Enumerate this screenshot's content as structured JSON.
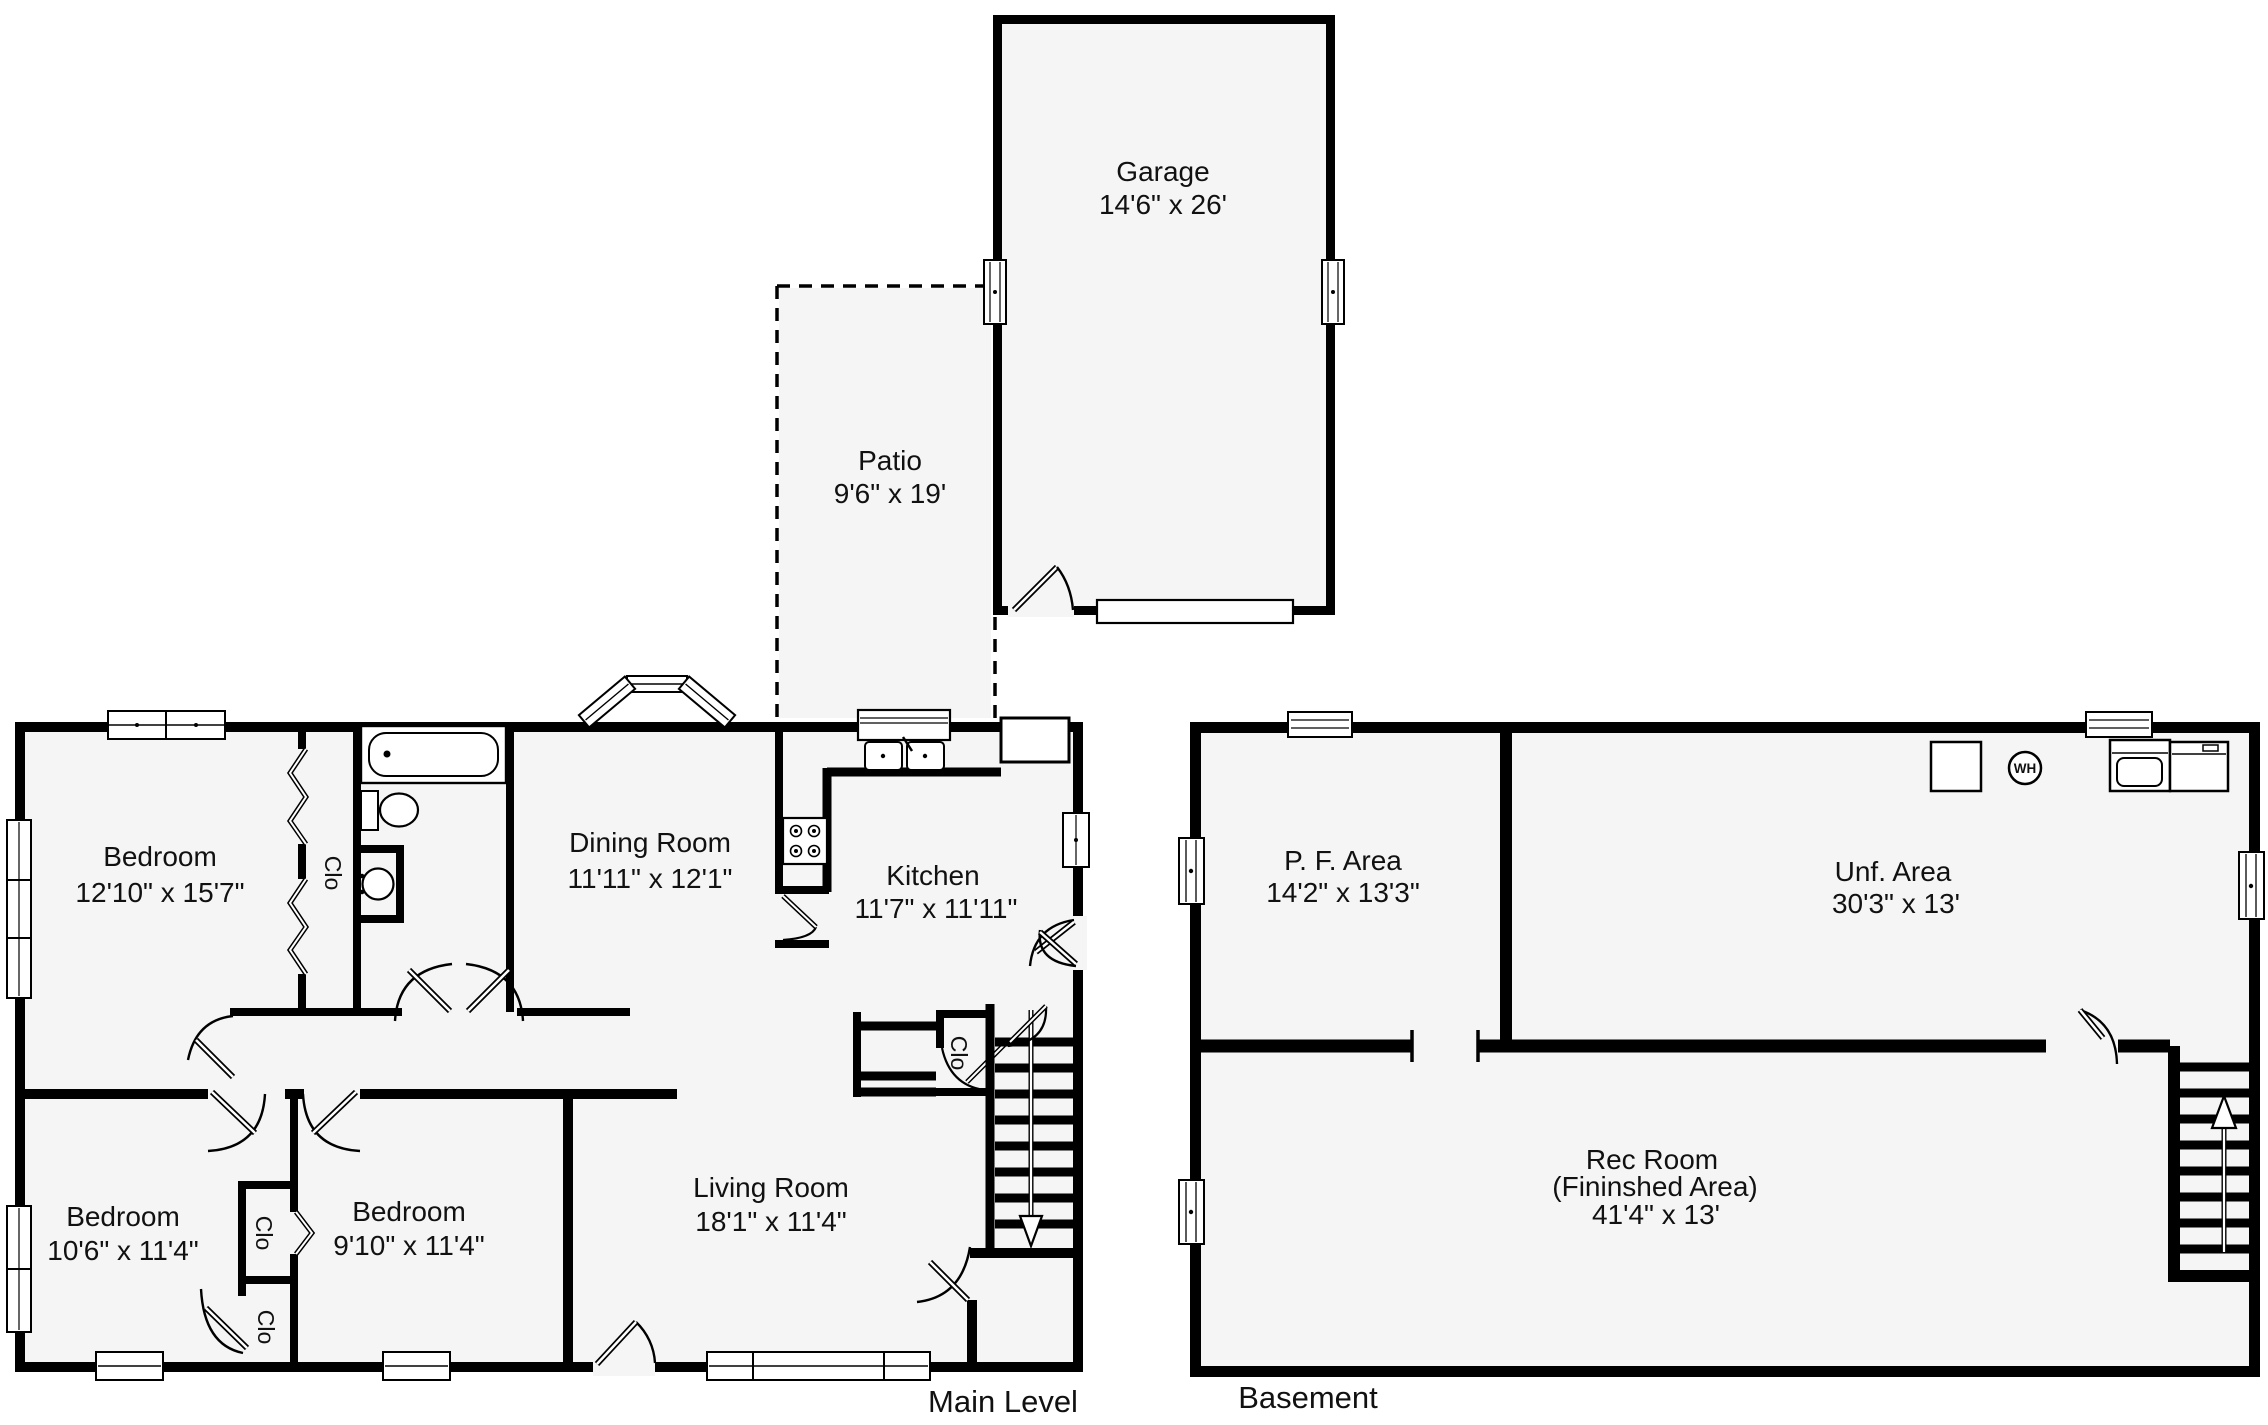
{
  "title": "Residential Floor Plan",
  "colors": {
    "wall": "#000000",
    "floor_fill": "#f5f5f5",
    "background": "#ffffff",
    "text": "#111111"
  },
  "garage": {
    "name": "Garage",
    "dims": "14'6\" x 26'"
  },
  "patio": {
    "name": "Patio",
    "dims": "9'6\" x 19'"
  },
  "main": {
    "caption": "Main Level",
    "rooms": {
      "bedroom1": {
        "name": "Bedroom",
        "dims": "12'10\" x 15'7\""
      },
      "dining": {
        "name": "Dining Room",
        "dims": "11'11\" x 12'1\""
      },
      "kitchen": {
        "name": "Kitchen",
        "dims": "11'7\" x 11'11\""
      },
      "living": {
        "name": "Living Room",
        "dims": "18'1\" x 11'4\""
      },
      "bedroom2": {
        "name": "Bedroom",
        "dims": "10'6\" x 11'4\""
      },
      "bedroom3": {
        "name": "Bedroom",
        "dims": "9'10\" x 11'4\""
      }
    }
  },
  "basement": {
    "caption": "Basement",
    "rooms": {
      "pf": {
        "name": "P. F. Area",
        "dims": "14'2\" x 13'3\""
      },
      "unf": {
        "name": "Unf. Area",
        "dims": "30'3\" x 13'"
      },
      "rec": {
        "name": "Rec Room",
        "sub": "(Fininshed Area)",
        "dims": "41'4\" x 13'"
      }
    }
  },
  "labels": {
    "closet": "Clo",
    "water_heater": "WH"
  }
}
